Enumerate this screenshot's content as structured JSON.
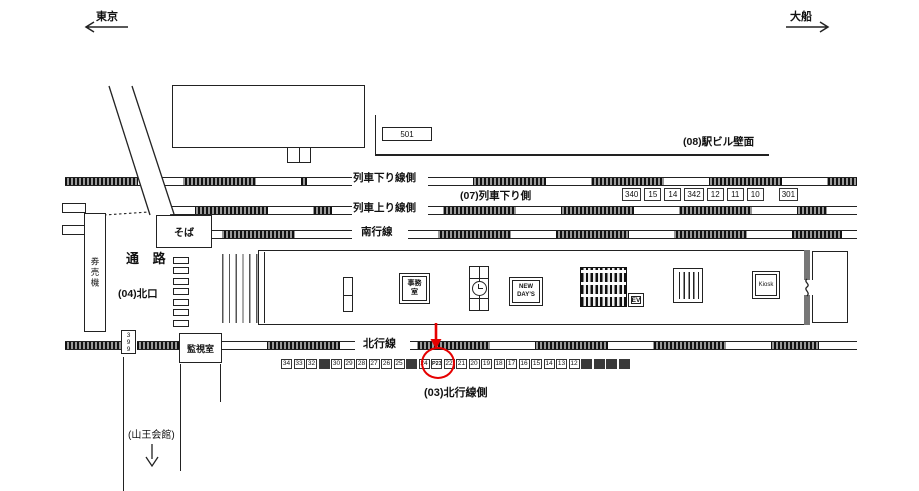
{
  "directions": {
    "left_label": "東京",
    "right_label": "大船"
  },
  "track_labels": {
    "train_down_side": "列車下り線側",
    "train_up_side": "列車上り線側",
    "south_line": "南行線",
    "north_line": "北行線"
  },
  "area_labels": {
    "a07": "(07)列車下り側",
    "a08": "(08)駅ビル壁面",
    "a03": "(03)北行線側",
    "a04": "(04)北口"
  },
  "facility_labels": {
    "passage": "通 路",
    "soba": "そば",
    "ticket_machines": "券売機",
    "monitor_room": "監視室",
    "office_lines": [
      "事務",
      "室"
    ],
    "newdays_lines": [
      "NEW",
      "DAY’S"
    ],
    "ev": "EV",
    "kiosk": "Kiosk",
    "sanno_hall": "(山王会館)"
  },
  "board_501": "501",
  "board_399": "399",
  "upper_boards": [
    {
      "label": "340",
      "thick": true
    },
    {
      "label": "15"
    },
    {
      "label": "14"
    },
    {
      "label": "342",
      "thick": true
    },
    {
      "label": "12"
    },
    {
      "label": "11"
    },
    {
      "label": "10"
    },
    {
      "label": "301",
      "gap_before": true
    }
  ],
  "lower_boards": [
    {
      "label": "34"
    },
    {
      "label": "33"
    },
    {
      "label": "32"
    },
    {
      "type": "dark"
    },
    {
      "label": "30"
    },
    {
      "label": "29"
    },
    {
      "label": "28"
    },
    {
      "label": "27"
    },
    {
      "label": "26"
    },
    {
      "label": "25"
    },
    {
      "type": "dark"
    },
    {
      "label": "24"
    },
    {
      "label": "P23",
      "type": "highlight"
    },
    {
      "label": "22"
    },
    {
      "label": "21"
    },
    {
      "label": "20"
    },
    {
      "label": "19"
    },
    {
      "label": "18"
    },
    {
      "label": "17"
    },
    {
      "label": "16"
    },
    {
      "label": "15"
    },
    {
      "label": "14"
    },
    {
      "label": "13"
    },
    {
      "label": "12"
    },
    {
      "type": "dark"
    },
    {
      "type": "dark"
    },
    {
      "type": "dark"
    },
    {
      "type": "dark"
    }
  ],
  "marker": {
    "target": "P23",
    "color": "#e60000"
  }
}
